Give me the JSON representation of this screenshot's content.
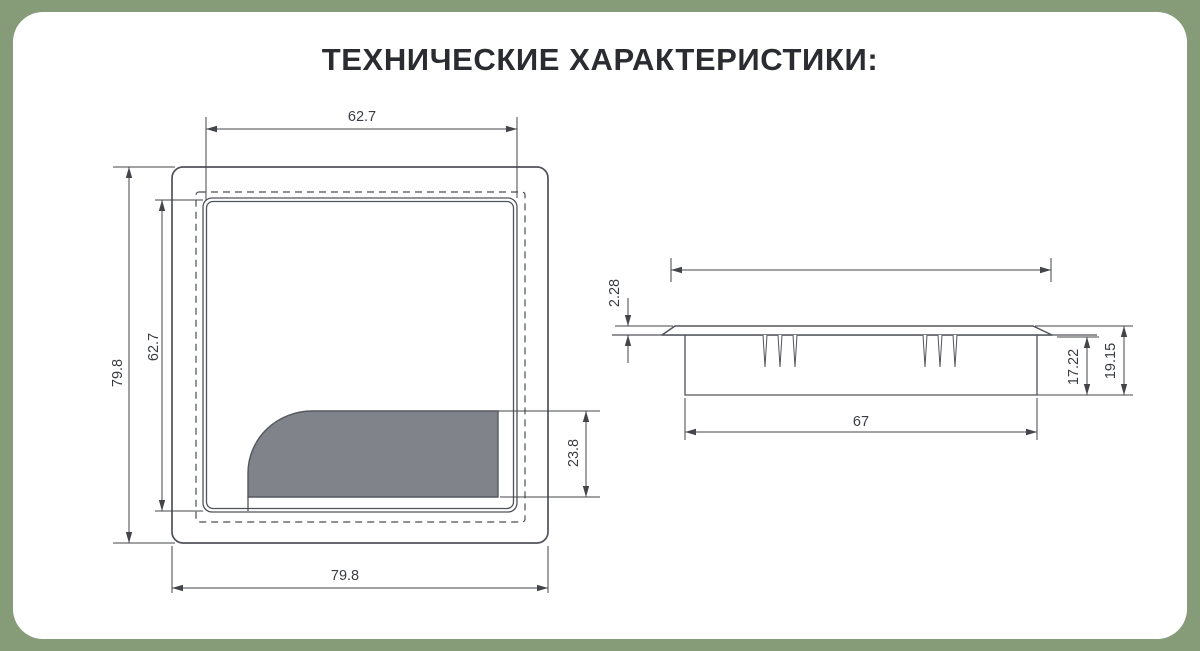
{
  "title": "ТЕХНИЧЕСКИЕ ХАРАКТЕРИСТИКИ:",
  "colors": {
    "background": "#869B77",
    "card": "#FFFFFF",
    "line": "#50535A",
    "lid_fill": "#808389",
    "text": "#2A2C31"
  },
  "top_view": {
    "label": "top view of square cable grommet",
    "dimensions": {
      "inner_width": "62.7",
      "inner_height": "62.7",
      "outer_width": "79.8",
      "outer_height": "79.8",
      "lid_opening_depth": "23.8"
    }
  },
  "side_view": {
    "label": "side section view of grommet",
    "dimensions": {
      "flange_thickness": "2.28",
      "insert_depth": "17.22",
      "total_height": "19.15",
      "cutout_width": "67"
    }
  }
}
